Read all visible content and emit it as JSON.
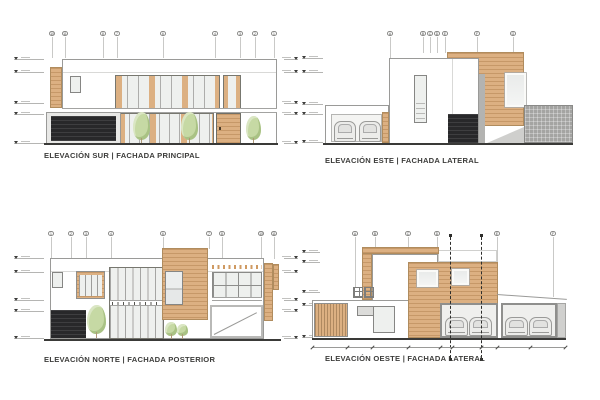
{
  "colors": {
    "wood": "#dcb082",
    "wood_line": "#c2935f",
    "glass": "#eef0ee",
    "dark_panel": "#28282a",
    "frame": "#8e8e8c",
    "ground_line": "#3a3a38",
    "tree": "#c6d9a4",
    "hatch_wall": "#a4a4a2",
    "title_text": "#3d3d3b"
  },
  "elevations": {
    "south": {
      "title": "ELEVACIÓN SUR | FACHADA PRINCIPAL",
      "grid_bubbles": [
        "10",
        "11",
        "8",
        "7",
        "6",
        "4",
        "3",
        "2",
        "1"
      ]
    },
    "east": {
      "title": "ELEVACIÓN ESTE | FACHADA LATERAL",
      "grid_bubbles": [
        "A",
        "B",
        "C",
        "D",
        "E",
        "F",
        "G"
      ]
    },
    "north": {
      "title": "ELEVACIÓN NORTE | FACHADA POSTERIOR",
      "grid_bubbles": [
        "1",
        "2",
        "3",
        "4",
        "6",
        "7",
        "8",
        "10",
        "11"
      ]
    },
    "west": {
      "title": "ELEVACIÓN OESTE | FACHADA LATERAL",
      "grid_bubbles": [
        "A",
        "B",
        "C",
        "D",
        "E",
        "F"
      ]
    }
  }
}
